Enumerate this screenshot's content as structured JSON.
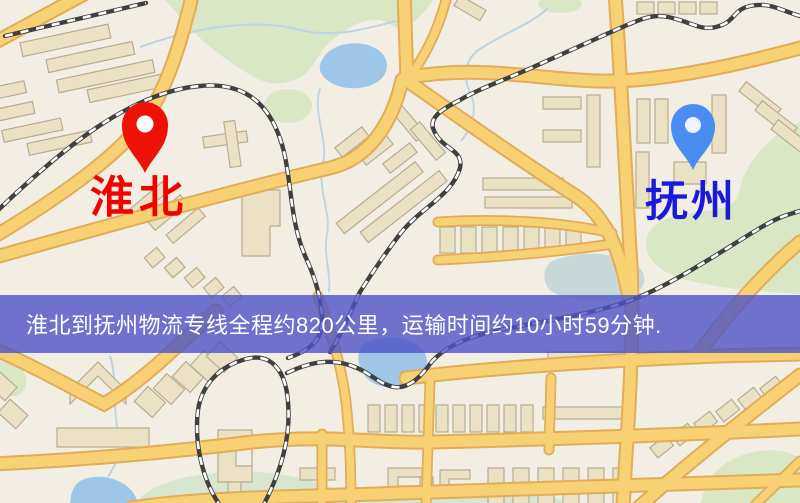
{
  "banner": {
    "text": "淮北到抚州物流专线全程约820公里，运输时间约10小时59分钟.",
    "background_color": "rgba(76,82,198,0.80)",
    "text_color": "#ffffff"
  },
  "markers": {
    "origin": {
      "label": "淮北",
      "pin_color": "#ee1206",
      "pin_hole_color": "#ffffff",
      "label_color": "#f40000"
    },
    "destination": {
      "label": "抚州",
      "pin_color": "#4a8df2",
      "pin_hole_color": "#eef4ff",
      "label_color": "#1b1ad9"
    }
  },
  "map_colors": {
    "background": "#f3eee4",
    "park_green": "#d9e7c4",
    "water_blue": "#9dc6e8",
    "road_fill": "#f7d173",
    "road_casing": "#e2ad58",
    "building_fill": "#ebe2c6",
    "railway_dark": "#404040"
  }
}
